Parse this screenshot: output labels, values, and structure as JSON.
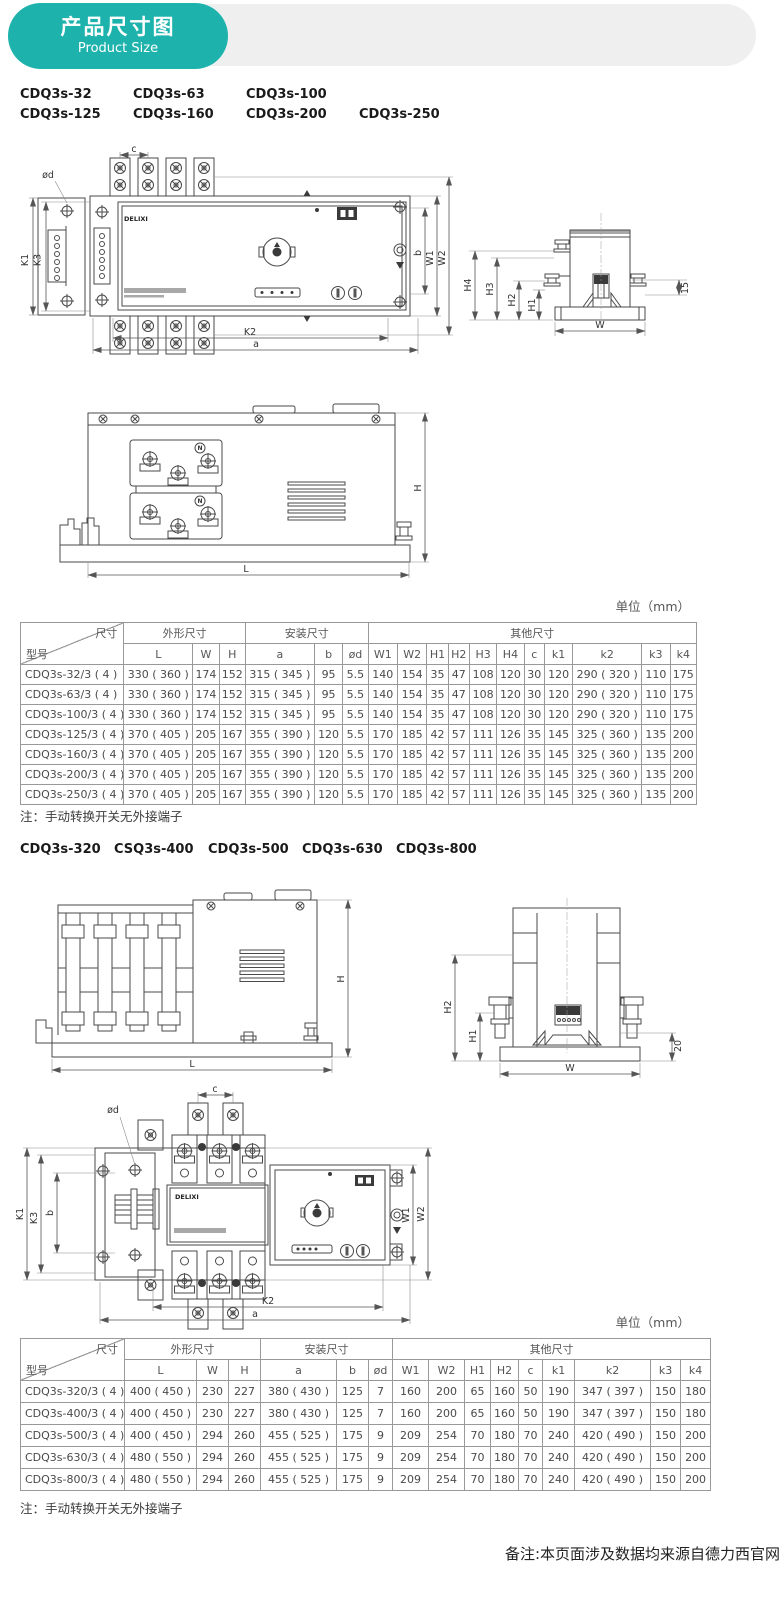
{
  "header": {
    "title_cn": "产品尺寸图",
    "title_en": "Product Size",
    "badge_color": "#1db3ac"
  },
  "models_small_row1": [
    "CDQ3s-32",
    "CDQ3s-63",
    "CDQ3s-100"
  ],
  "models_small_row2": [
    "CDQ3s-125",
    "CDQ3s-160",
    "CDQ3s-200",
    "CDQ3s-250"
  ],
  "models_large": [
    "CDQ3s-320",
    "CSQ3s-400",
    "CDQ3s-500",
    "CDQ3s-630",
    "CDQ3s-800"
  ],
  "unit_label": "单位（mm）",
  "note": "注：手动转换开关无外接端子",
  "footer_note": "备注:本页面涉及数据均来源自德力西官网",
  "diagrams": {
    "front_small": {
      "c": "c",
      "od": "ød",
      "k1": "K1",
      "k3": "K3",
      "b": "b",
      "w1": "W1",
      "w2": "W2",
      "k2": "K2",
      "a": "a",
      "brand": "DELIXI"
    },
    "side_small": {
      "h4": "H4",
      "h3": "H3",
      "h2": "H2",
      "h1": "H1",
      "offset": "15",
      "w": "W"
    },
    "elev_small": {
      "h": "H",
      "l": "L",
      "n": "N"
    },
    "elev_large": {
      "h": "H",
      "l": "L"
    },
    "end_large": {
      "h2": "H2",
      "h1": "H1",
      "offset": "20",
      "w": "W"
    },
    "front_large": {
      "od": "ød",
      "c": "c",
      "k1": "K1",
      "k3": "K3",
      "b": "b",
      "w1": "W1",
      "w2": "W2",
      "k2": "K2",
      "a": "a",
      "brand": "DELIXI"
    }
  },
  "table1": {
    "corner_top": "尺寸",
    "corner_bottom": "型号",
    "group_shape": "外形尺寸",
    "group_install": "安装尺寸",
    "group_other": "其他尺寸",
    "columns": [
      "L",
      "W",
      "H",
      "a",
      "b",
      "ød",
      "W1",
      "W2",
      "H1",
      "H2",
      "H3",
      "H4",
      "c",
      "k1",
      "k2",
      "k3",
      "k4"
    ],
    "rows": [
      {
        "model": "CDQ3s-32/3 ( 4 )",
        "values": [
          "330 ( 360 )",
          "174",
          "152",
          "315 ( 345 )",
          "95",
          "5.5",
          "140",
          "154",
          "35",
          "47",
          "108",
          "120",
          "30",
          "120",
          "290 ( 320 )",
          "110",
          "175"
        ]
      },
      {
        "model": "CDQ3s-63/3 ( 4 )",
        "values": [
          "330 ( 360 )",
          "174",
          "152",
          "315 ( 345 )",
          "95",
          "5.5",
          "140",
          "154",
          "35",
          "47",
          "108",
          "120",
          "30",
          "120",
          "290 ( 320 )",
          "110",
          "175"
        ]
      },
      {
        "model": "CDQ3s-100/3 ( 4 )",
        "values": [
          "330 ( 360 )",
          "174",
          "152",
          "315 ( 345 )",
          "95",
          "5.5",
          "140",
          "154",
          "35",
          "47",
          "108",
          "120",
          "30",
          "120",
          "290 ( 320 )",
          "110",
          "175"
        ]
      },
      {
        "model": "CDQ3s-125/3 ( 4 )",
        "values": [
          "370 ( 405 )",
          "205",
          "167",
          "355 ( 390 )",
          "120",
          "5.5",
          "170",
          "185",
          "42",
          "57",
          "111",
          "126",
          "35",
          "145",
          "325 ( 360 )",
          "135",
          "200"
        ]
      },
      {
        "model": "CDQ3s-160/3 ( 4 )",
        "values": [
          "370 ( 405 )",
          "205",
          "167",
          "355 ( 390 )",
          "120",
          "5.5",
          "170",
          "185",
          "42",
          "57",
          "111",
          "126",
          "35",
          "145",
          "325 ( 360 )",
          "135",
          "200"
        ]
      },
      {
        "model": "CDQ3s-200/3 ( 4 )",
        "values": [
          "370 ( 405 )",
          "205",
          "167",
          "355 ( 390 )",
          "120",
          "5.5",
          "170",
          "185",
          "42",
          "57",
          "111",
          "126",
          "35",
          "145",
          "325 ( 360 )",
          "135",
          "200"
        ]
      },
      {
        "model": "CDQ3s-250/3 ( 4 )",
        "values": [
          "370 ( 405 )",
          "205",
          "167",
          "355 ( 390 )",
          "120",
          "5.5",
          "170",
          "185",
          "42",
          "57",
          "111",
          "126",
          "35",
          "145",
          "325 ( 360 )",
          "135",
          "200"
        ]
      }
    ]
  },
  "table2": {
    "corner_top": "尺寸",
    "corner_bottom": "型号",
    "group_shape": "外形尺寸",
    "group_install": "安装尺寸",
    "group_other": "其他尺寸",
    "columns": [
      "L",
      "W",
      "H",
      "a",
      "b",
      "ød",
      "W1",
      "W2",
      "H1",
      "H2",
      "c",
      "k1",
      "k2",
      "k3",
      "k4"
    ],
    "rows": [
      {
        "model": "CDQ3s-320/3 ( 4 )",
        "values": [
          "400 ( 450 )",
          "230",
          "227",
          "380 ( 430 )",
          "125",
          "7",
          "160",
          "200",
          "65",
          "160",
          "50",
          "190",
          "347 ( 397 )",
          "150",
          "180"
        ]
      },
      {
        "model": "CDQ3s-400/3 ( 4 )",
        "values": [
          "400 ( 450 )",
          "230",
          "227",
          "380 ( 430 )",
          "125",
          "7",
          "160",
          "200",
          "65",
          "160",
          "50",
          "190",
          "347 ( 397 )",
          "150",
          "180"
        ]
      },
      {
        "model": "CDQ3s-500/3 ( 4 )",
        "values": [
          "400 ( 450 )",
          "294",
          "260",
          "455 ( 525 )",
          "175",
          "9",
          "209",
          "254",
          "70",
          "180",
          "70",
          "240",
          "420 ( 490 )",
          "150",
          "200"
        ]
      },
      {
        "model": "CDQ3s-630/3 ( 4 )",
        "values": [
          "480 ( 550 )",
          "294",
          "260",
          "455 ( 525 )",
          "175",
          "9",
          "209",
          "254",
          "70",
          "180",
          "70",
          "240",
          "420 ( 490 )",
          "150",
          "200"
        ]
      },
      {
        "model": "CDQ3s-800/3 ( 4 )",
        "values": [
          "480 ( 550 )",
          "294",
          "260",
          "455 ( 525 )",
          "175",
          "9",
          "209",
          "254",
          "70",
          "180",
          "70",
          "240",
          "420 ( 490 )",
          "150",
          "200"
        ]
      }
    ]
  }
}
